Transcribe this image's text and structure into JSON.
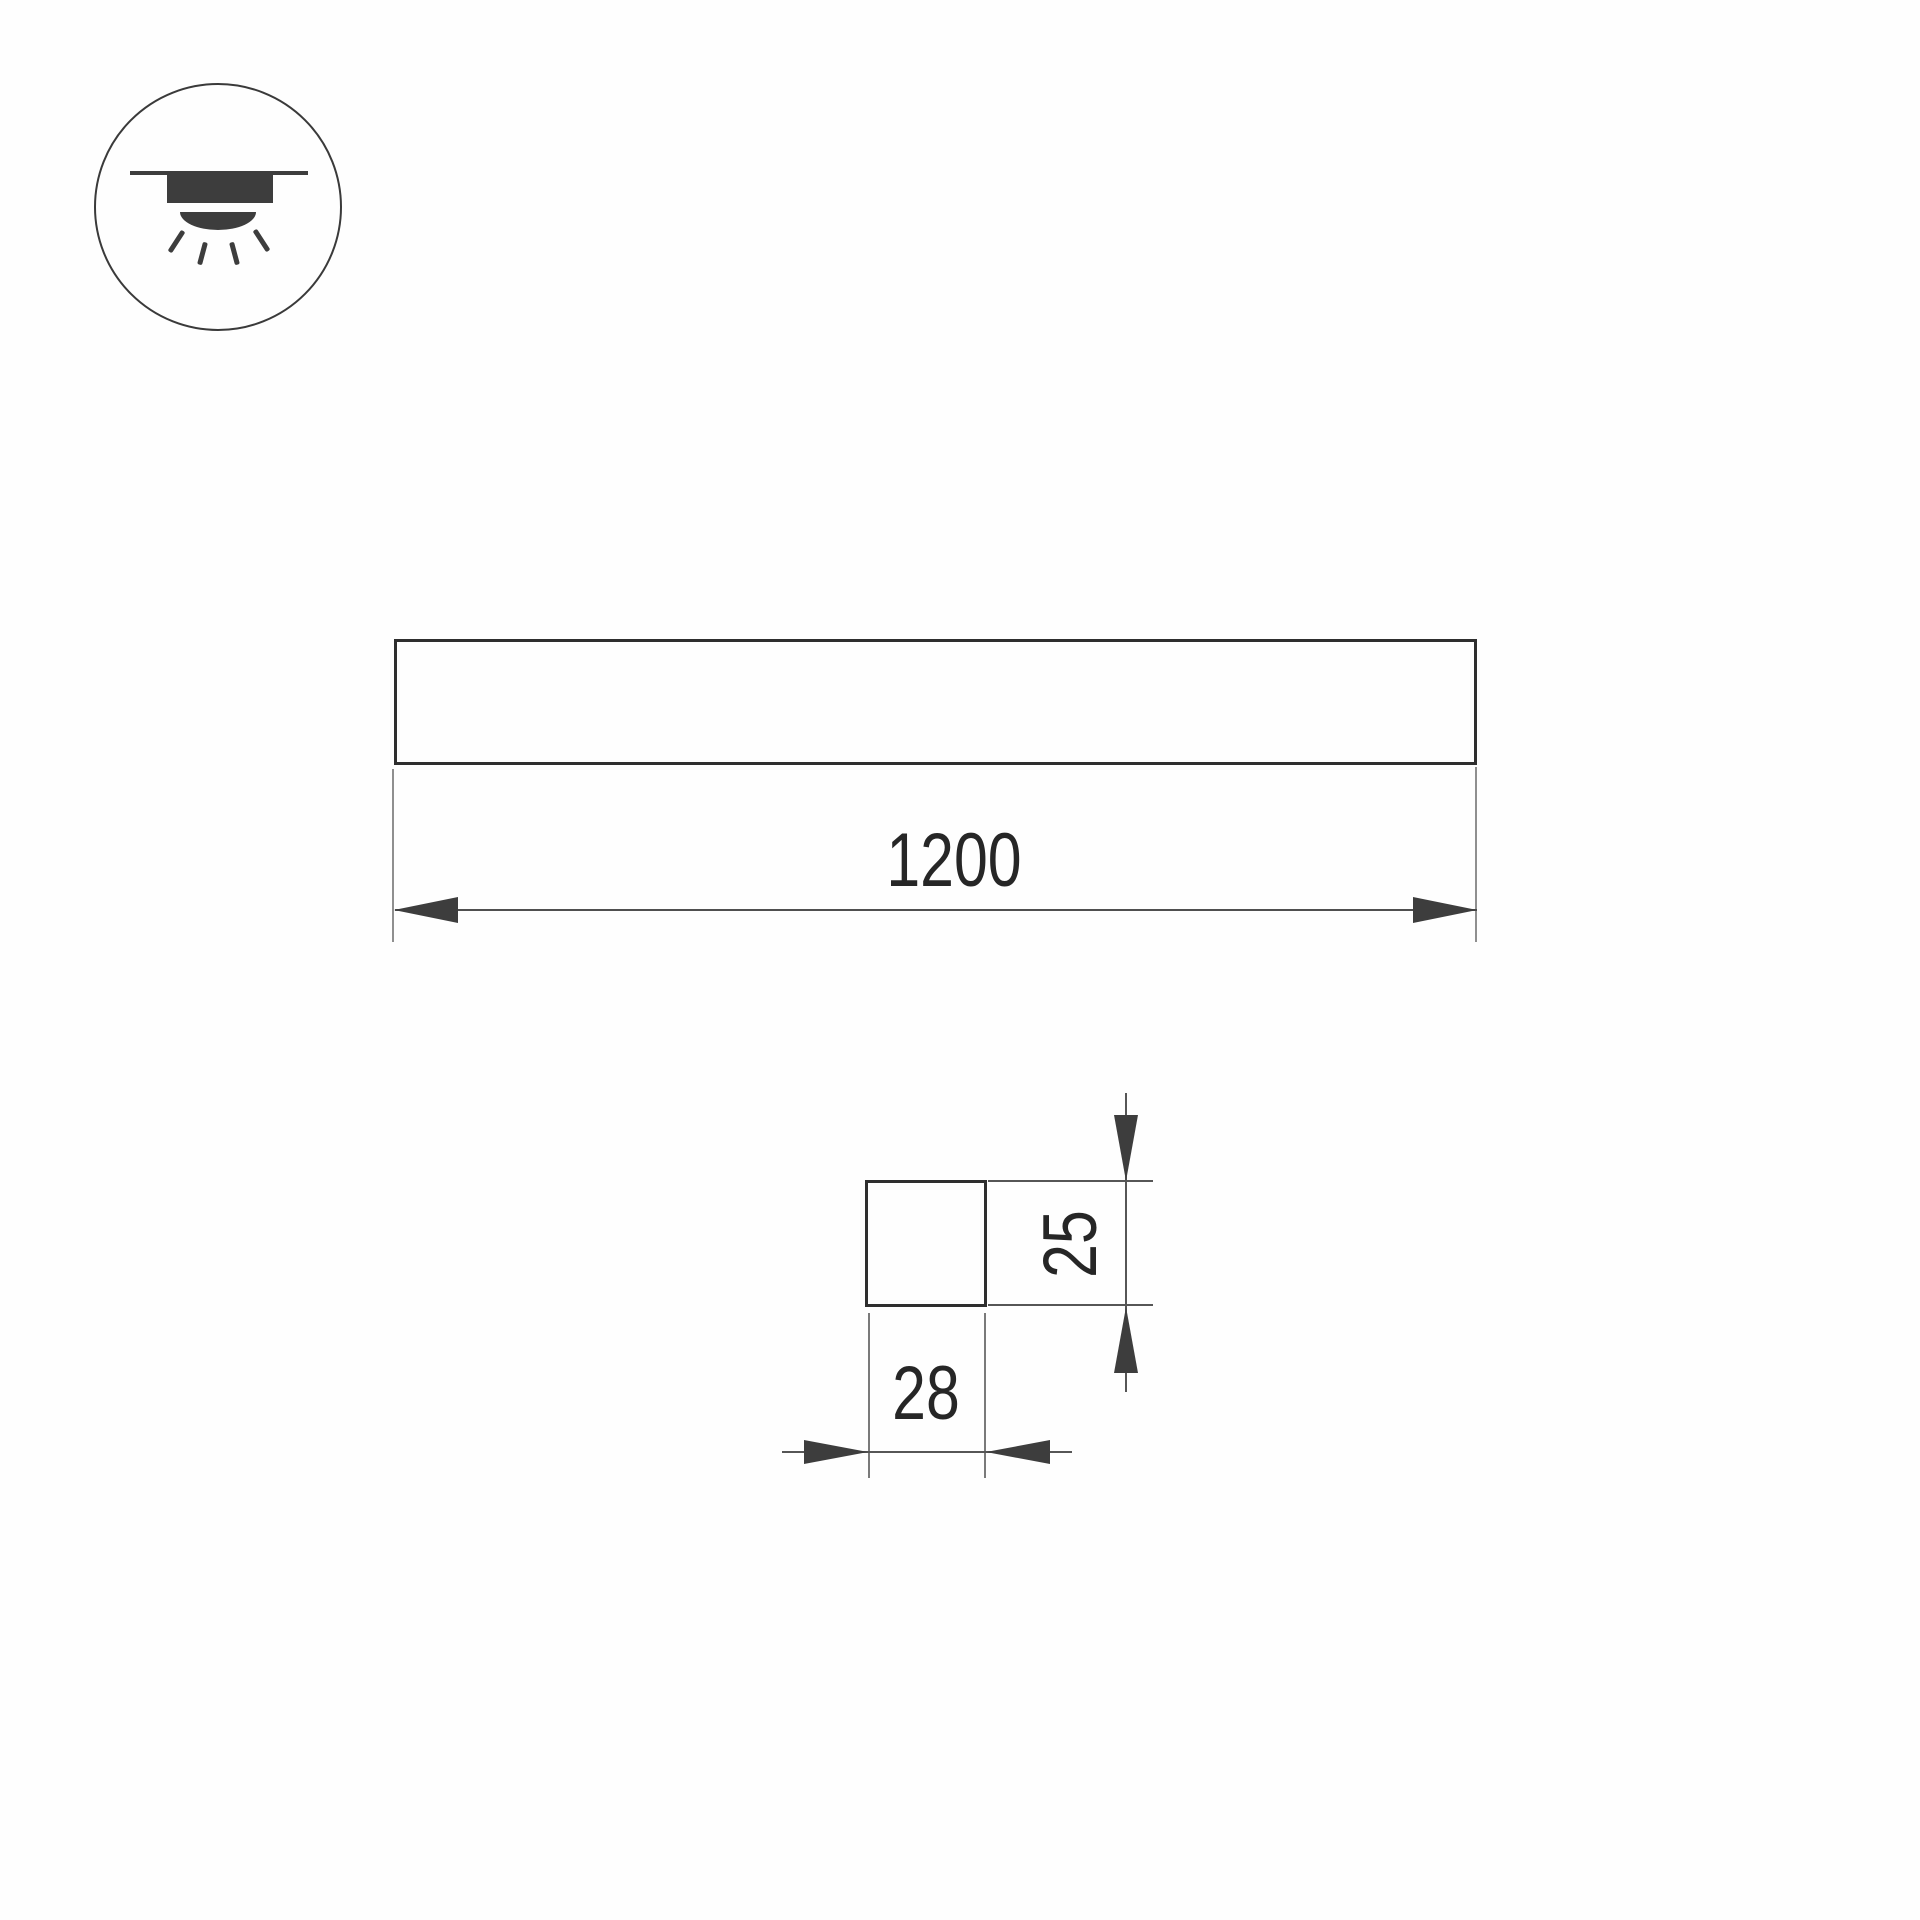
{
  "drawing": {
    "type": "luminaire-dimension-drawing",
    "mount_icon": {
      "name": "recessed-ceiling-downlight-icon",
      "ray_count": 4
    },
    "front_view": {
      "length_label": "1200"
    },
    "section_view": {
      "width_label": "28",
      "height_label": "25"
    }
  },
  "colors": {
    "background": "#fefefe",
    "outline": "#2e2e2e",
    "icon_fill": "#3d3d3d",
    "dimension_line": "#4f4f4f",
    "extension_line": "#8f8f8f",
    "arrow_fill": "#3d3d3d",
    "text": "#262626"
  }
}
